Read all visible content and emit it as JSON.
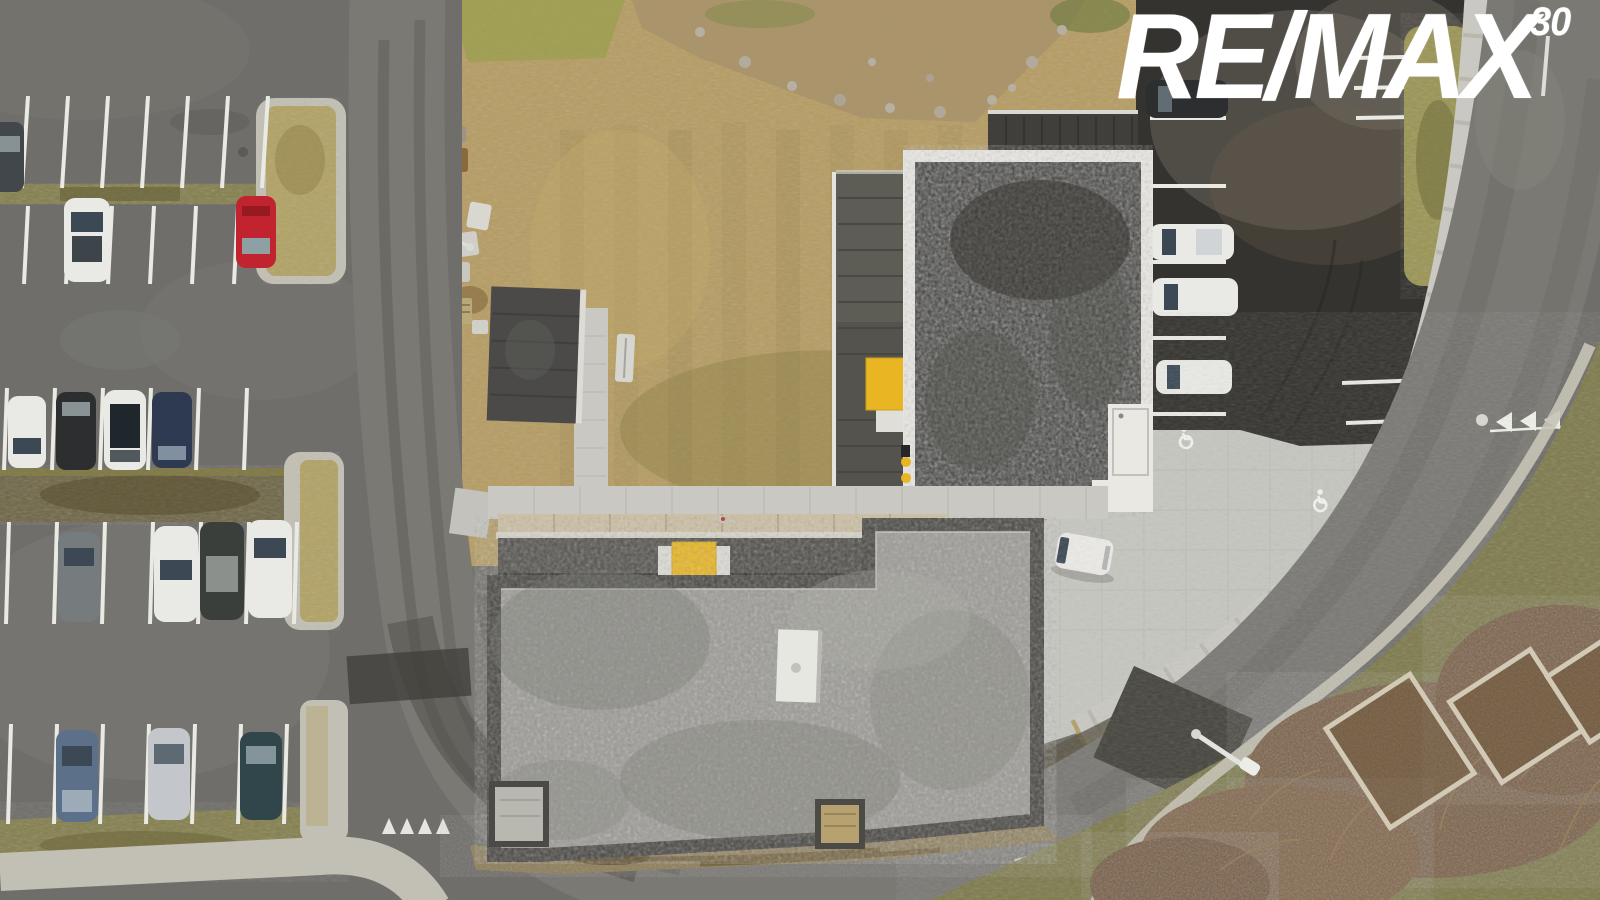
{
  "watermark": {
    "brand": "RE/MAX",
    "superscript": "30",
    "color": "#ffffff"
  },
  "scene": {
    "type": "aerial-drone-photo",
    "description": "Top-down drone photo of a new-build commercial property: two flat gravel-roof buildings with yellow entrance canopies, a light paved plaza with accessible-parking symbols and a white van, an older car park full of cars on the left, a fresh dark asphalt car park top right, a tan vacant field, and a curving perimeter road with give-way triangle markings.",
    "palette": {
      "asphalt_lot": "#6f6e6a",
      "asphalt_new": "#34332f",
      "asphalt_road": "#7a7974",
      "line_white": "#eaeae4",
      "concrete": "#c2bfb4",
      "paver_plaza": "#c6c6c0",
      "paver_walk": "#c9c8c2",
      "terrace_tan": "#ccbfa3",
      "field_tan": "#b59c60",
      "grass_olive": "#85804a",
      "grass_dead": "#6f6642",
      "verge_green": "#7e7a47",
      "bush_brown": "#7d6245",
      "soil_brown": "#8c7b52",
      "roof_gravel_dark": "#45443f",
      "roof_gravel_light": "#9c9b95",
      "parapet_white": "#e9e8e3",
      "parapet_dark": "#4b4a46",
      "annex_gray": "#54534e",
      "accent_yellow": "#e9b522",
      "gold_wood": "#b2984f",
      "van_white": "#eceae6",
      "car_white": "#e9e9e6",
      "car_black": "#2c2e30",
      "car_navy": "#2e3a52",
      "car_red": "#c2242f",
      "car_silver": "#c3c7cb",
      "car_gray": "#767c7d",
      "car_steel": "#5d7089",
      "car_teal": "#30464a",
      "car_darkgray": "#42474b",
      "windshield": "#3c4955"
    }
  }
}
